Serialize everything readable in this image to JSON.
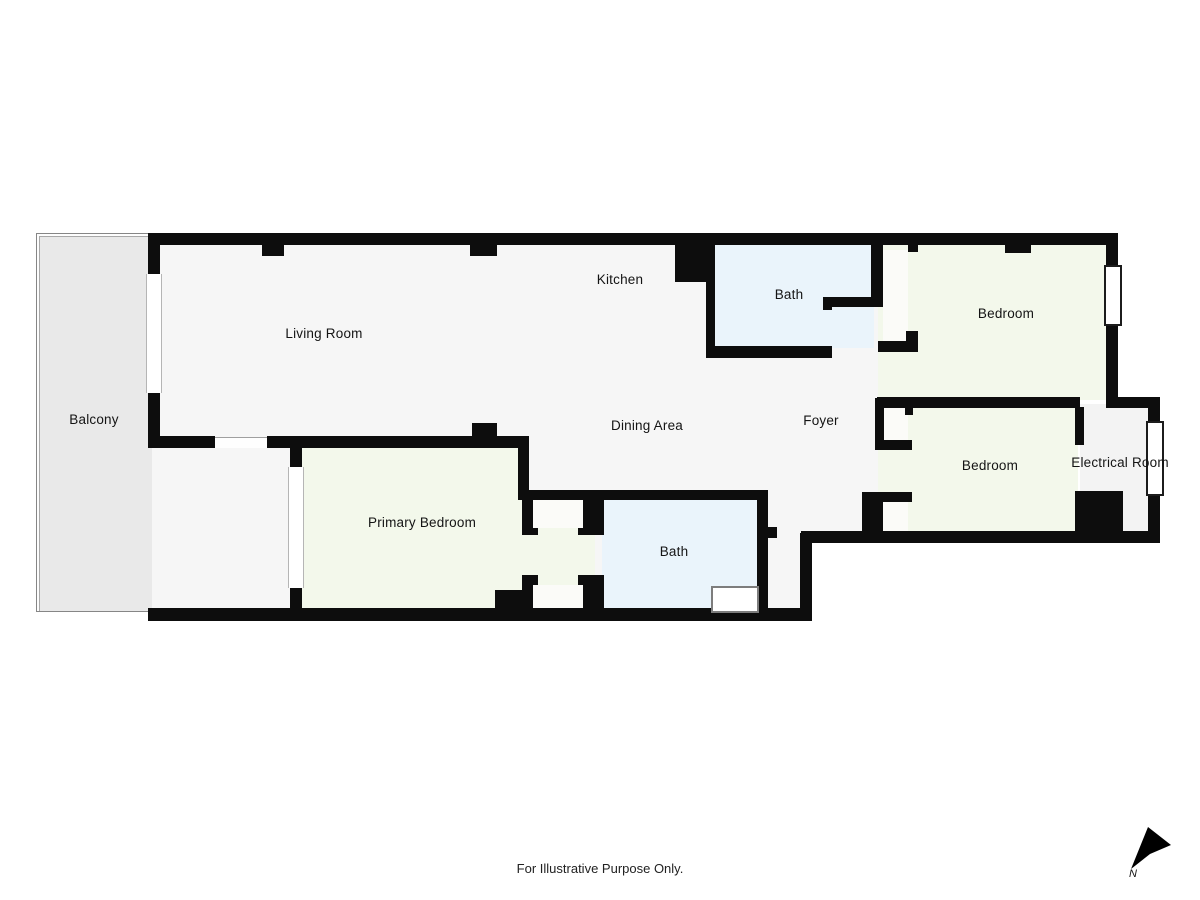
{
  "plan": {
    "rooms": {
      "balcony": {
        "label": "Balcony"
      },
      "living_room": {
        "label": "Living Room"
      },
      "kitchen": {
        "label": "Kitchen"
      },
      "bath_top": {
        "label": "Bath"
      },
      "bedroom_top_right": {
        "label": "Bedroom"
      },
      "dining_area": {
        "label": "Dining Area"
      },
      "foyer": {
        "label": "Foyer"
      },
      "bedroom_bottom_right": {
        "label": "Bedroom"
      },
      "electrical_room": {
        "label": "Electrical Room"
      },
      "primary_bedroom": {
        "label": "Primary Bedroom"
      },
      "bath_bottom": {
        "label": "Bath"
      }
    },
    "compass": {
      "north_label": "N"
    },
    "disclaimer": "For Illustrative Purpose Only.",
    "colors": {
      "wall": "#0d0d0d",
      "floor_main": "#f6f6f6",
      "floor_bedroom": "#f3f8eb",
      "floor_bath": "#eaf4fb",
      "floor_balcony": "#e9e9e9",
      "floor_electrical": "#f3f3f3"
    }
  }
}
